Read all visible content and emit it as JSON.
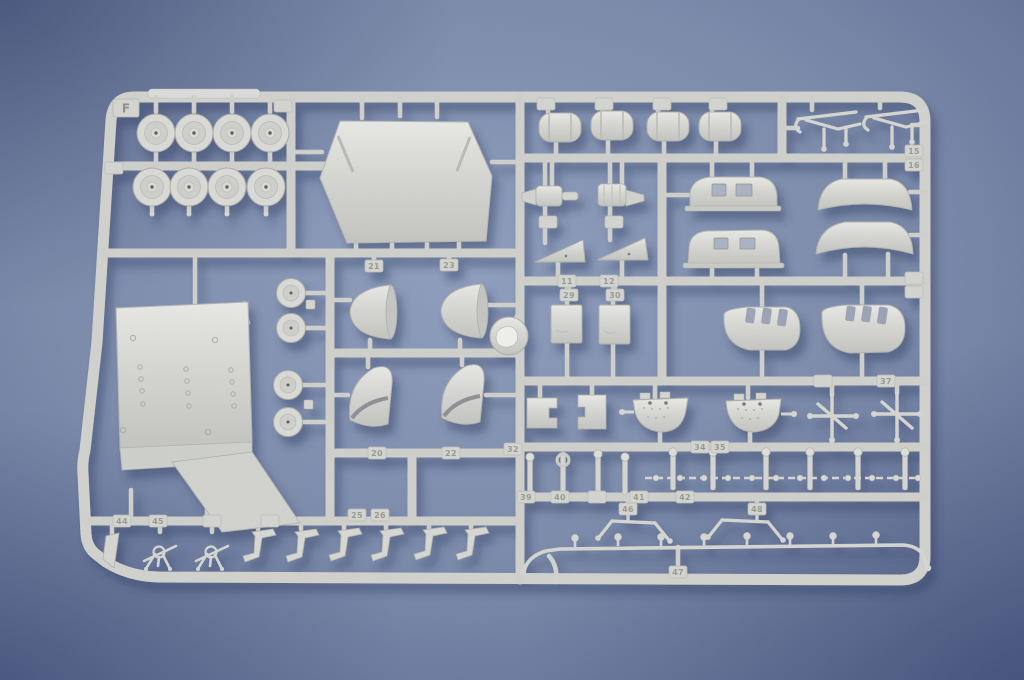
{
  "photo": {
    "subject": "light-gray injection-molded plastic model kit sprue photographed on a blue backdrop",
    "colors": {
      "backdrop": "#7585a4",
      "plastic": "#d3d4d0",
      "shadow": "#35426a"
    }
  },
  "sprue": {
    "runner_letter": "F",
    "part_tags": {
      "t11": "11",
      "t12": "12",
      "t15": "15",
      "t16": "16",
      "t20": "20",
      "t21": "21",
      "t22": "22",
      "t23": "23",
      "t25": "25",
      "t26": "26",
      "t29": "29",
      "t30": "30",
      "t32": "32",
      "t34": "34",
      "t35": "35",
      "t37": "37",
      "t39": "39",
      "t40": "40",
      "t41": "41",
      "t42": "42",
      "t44": "44",
      "t45": "45",
      "t46": "46",
      "t47": "47",
      "t48": "48"
    },
    "part_counts": {
      "wheels_large": 8,
      "wheels_small": 4,
      "hood_panel": 1,
      "drum_cylinders": 4,
      "pump_assemblies": 2,
      "roof_sections": 4,
      "engine_cowls": 2,
      "intake_scoops": 4,
      "tail_fins": 2,
      "hatch_plates": 2,
      "riveted_floor_panel": 1,
      "spinner_disc": 1,
      "gondola_hulls": 2,
      "linkage_crosses": 2,
      "mg_mounts": 2,
      "step_brackets": 6,
      "tripod_guns": 2,
      "blade_part": 1,
      "track_chain": 1,
      "long_rod": 1,
      "small_pins": 10
    }
  }
}
